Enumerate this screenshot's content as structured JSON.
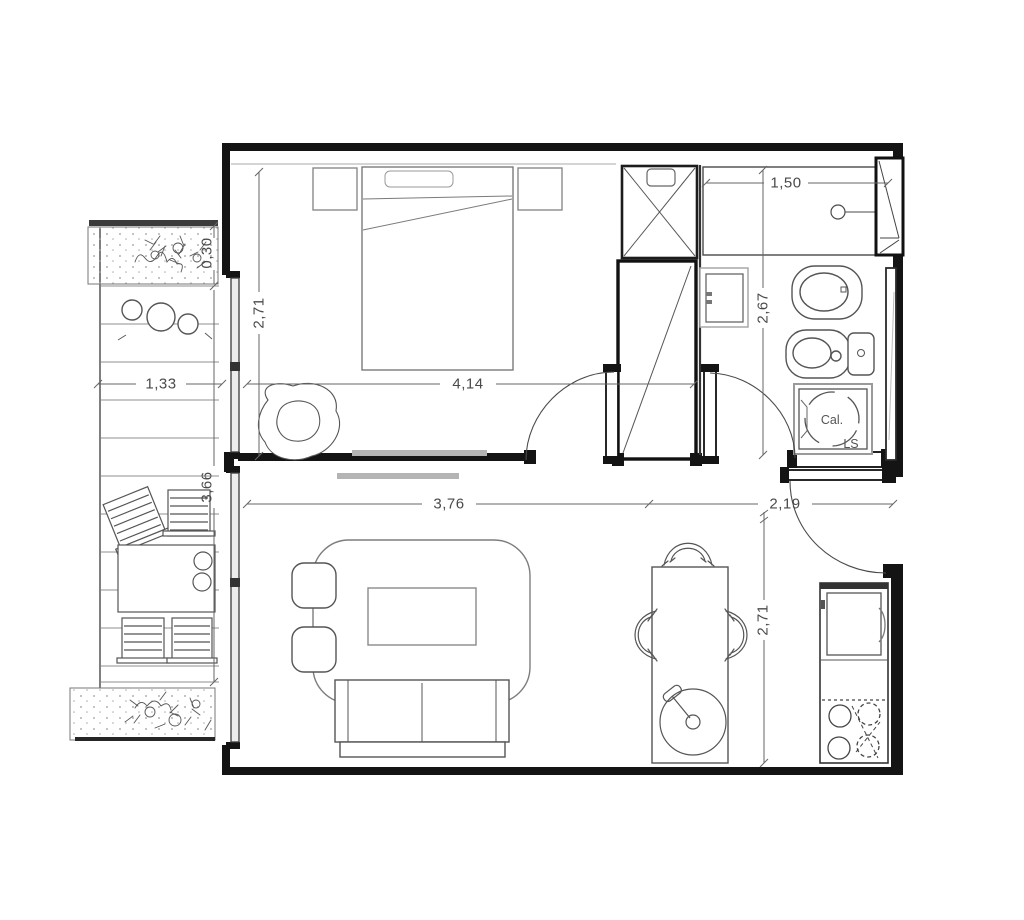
{
  "plan": {
    "type": "apartment-floor-plan",
    "dimensions": {
      "bedroom_width": "4,14",
      "bedroom_depth": "2,71",
      "balcony_width": "1,33",
      "planter_depth": "0,30",
      "balcony_length": "3,66",
      "shower_width": "1,50",
      "bathroom_depth": "2,67",
      "living_width": "3,76",
      "entry_width": "2,19",
      "dining_depth": "2,71"
    },
    "labels": {
      "water_heater": "Cal.",
      "laundry_sink": "LS"
    },
    "colors": {
      "wall": "#141414",
      "line": "#4a4a4a",
      "furniture": "#7a7a7a",
      "light_gray": "#b4b4b4"
    }
  }
}
